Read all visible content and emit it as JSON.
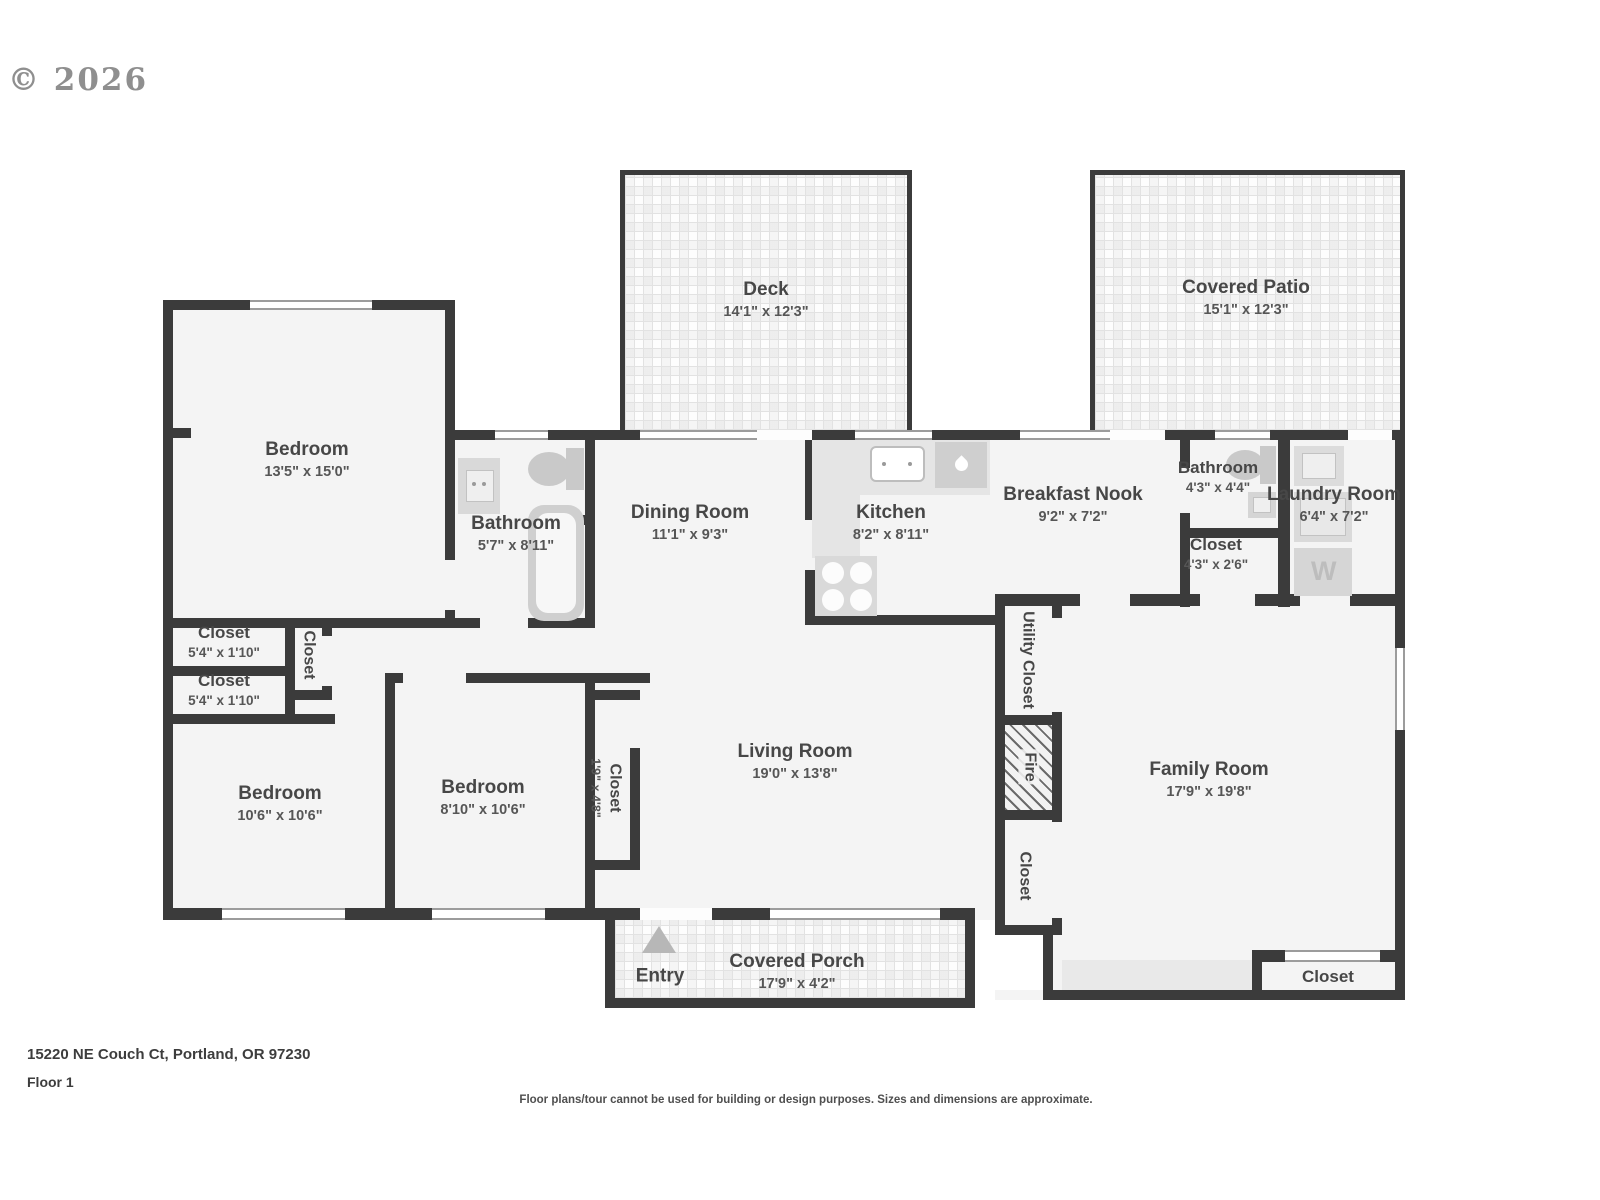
{
  "copyright": "© 2026",
  "footer": {
    "address": "15220 NE Couch Ct, Portland, OR 97230",
    "floor": "Floor 1",
    "disclaimer": "Floor plans/tour cannot be used for building or design purposes. Sizes and dimensions are approximate."
  },
  "colors": {
    "wall": "#3b3b3b",
    "room_fill": "#f4f4f4",
    "fixture": "#d9d9d9",
    "label_text": "#474747"
  },
  "rooms": {
    "deck": {
      "name": "Deck",
      "dims": "14'1\" x 12'3\""
    },
    "covered_patio": {
      "name": "Covered Patio",
      "dims": "15'1\" x 12'3\""
    },
    "bedroom_master": {
      "name": "Bedroom",
      "dims": "13'5\" x 15'0\""
    },
    "bathroom_main": {
      "name": "Bathroom",
      "dims": "5'7\" x 8'11\""
    },
    "dining_room": {
      "name": "Dining Room",
      "dims": "11'1\" x 9'3\""
    },
    "kitchen": {
      "name": "Kitchen",
      "dims": "8'2\" x 8'11\""
    },
    "breakfast_nook": {
      "name": "Breakfast Nook",
      "dims": "9'2\" x 7'2\""
    },
    "bathroom_half": {
      "name": "Bathroom",
      "dims": "4'3\" x 4'4\""
    },
    "laundry_room": {
      "name": "Laundry Room",
      "dims": "6'4\" x 7'2\""
    },
    "closet_laundry": {
      "name": "Closet",
      "dims": "4'3\" x 2'6\""
    },
    "closet_hall_upper": {
      "name": "Closet",
      "dims": "5'4\" x 1'10\""
    },
    "closet_hall_lower": {
      "name": "Closet",
      "dims": "5'4\" x 1'10\""
    },
    "closet_hall_vertical": {
      "name": "Closet"
    },
    "bedroom_2": {
      "name": "Bedroom",
      "dims": "10'6\" x 10'6\""
    },
    "bedroom_3": {
      "name": "Bedroom",
      "dims": "8'10\" x 10'6\""
    },
    "closet_bedroom3": {
      "name": "Closet",
      "dims": "1'9\" x 4'8\""
    },
    "living_room": {
      "name": "Living Room",
      "dims": "19'0\" x 13'8\""
    },
    "utility_closet": {
      "name": "Utility Closet"
    },
    "fireplace": {
      "name": "Fire"
    },
    "closet_hallway_south": {
      "name": "Closet"
    },
    "family_room": {
      "name": "Family Room",
      "dims": "17'9\" x 19'8\""
    },
    "closet_family": {
      "name": "Closet"
    },
    "covered_porch": {
      "name": "Covered Porch",
      "dims": "17'9\" x 4'2\""
    },
    "entry": {
      "name": "Entry"
    }
  },
  "fixtures": {
    "washer_label": "W"
  }
}
